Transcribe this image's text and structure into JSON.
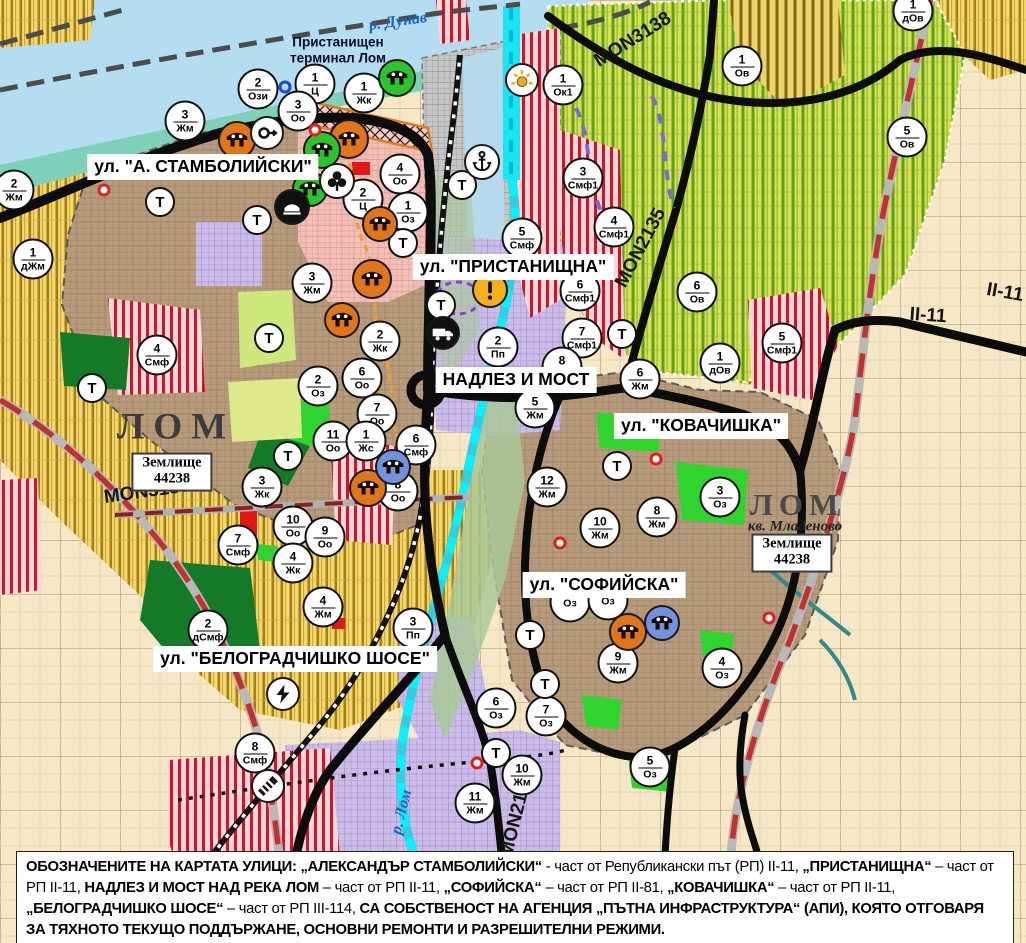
{
  "map": {
    "t_letter": "Т",
    "colors": {
      "water": "#b5ddf2",
      "river_cyan": "#18e4f4",
      "shore": "#7fd0b8",
      "urban": "#b79b7c",
      "center_pink": "#f2beb6",
      "industrial_lavender": "#cbbce8",
      "farmland_yellow": "#f4d76d",
      "orchard_green": "#dede52",
      "mixed_red_stripe": "#d01428",
      "park_green": "#2fd42f",
      "forest_green": "#157a28",
      "port_gray": "#c6c6c6",
      "road_black": "#0c0c0c",
      "project_road_red": "#c23030",
      "beige": "#f6e8c6",
      "marker_orange": "#e0761c",
      "marker_green": "#2cc42c",
      "marker_blue": "#7292de",
      "warning_orange": "#f3b01c"
    },
    "street_labels": [
      {
        "text": "ул. \"А. СТАМБОЛИЙСКИ\"",
        "x": 203,
        "y": 167
      },
      {
        "text": "ул. \"ПРИСТАНИЩНА\"",
        "x": 513,
        "y": 267
      },
      {
        "text": "НАДЛЕЗ И МОСТ",
        "x": 516,
        "y": 380
      },
      {
        "text": "ул. \"КОВАЧИШКА\"",
        "x": 701,
        "y": 426
      },
      {
        "text": "ул. \"СОФИЙСКА\"",
        "x": 604,
        "y": 585
      },
      {
        "text": "ул. \"БЕЛОГРАДЧИШКО ШОСЕ\"",
        "x": 295,
        "y": 659
      }
    ],
    "road_labels": [
      {
        "text": "MON3138",
        "x": 633,
        "y": 40,
        "rot": -32
      },
      {
        "text": "MON2135",
        "x": 641,
        "y": 248,
        "rot": -62
      },
      {
        "text": "MON3139",
        "x": 147,
        "y": 492,
        "rot": -8
      },
      {
        "text": "MON2136",
        "x": 517,
        "y": 815,
        "rot": -76
      },
      {
        "text": "II-11",
        "x": 928,
        "y": 316,
        "rot": 4
      },
      {
        "text": "II-11",
        "x": 1005,
        "y": 293,
        "rot": 10
      }
    ],
    "place_labels": [
      {
        "kind": "water",
        "text": "р. Дунав",
        "x": 398,
        "y": 22,
        "rot": -8
      },
      {
        "kind": "water",
        "text": "р. Лом",
        "x": 402,
        "y": 812,
        "rot": -76
      },
      {
        "kind": "port",
        "text": "Пристанищен\nтерминал Лом",
        "x": 338,
        "y": 50
      },
      {
        "kind": "city",
        "text": "ЛОМ",
        "x": 176,
        "y": 427,
        "small": false
      },
      {
        "kind": "city",
        "text": "ЛОМ",
        "x": 797,
        "y": 505,
        "small": true
      },
      {
        "kind": "quarter",
        "text": "кв. Младеново",
        "x": 795,
        "y": 527
      },
      {
        "kind": "box",
        "text": "Землище\n44238",
        "x": 172,
        "y": 472
      },
      {
        "kind": "box",
        "text": "Землище\n44238",
        "x": 792,
        "y": 553
      }
    ],
    "zone_markers": [
      {
        "n": "2",
        "c": "Ози",
        "x": 258,
        "y": 89
      },
      {
        "n": "1",
        "c": "Ц",
        "x": 315,
        "y": 84
      },
      {
        "n": "3",
        "c": "Оо",
        "x": 298,
        "y": 111
      },
      {
        "n": "1",
        "c": "Жк",
        "x": 364,
        "y": 93
      },
      {
        "n": "3",
        "c": "Жм",
        "x": 185,
        "y": 121
      },
      {
        "n": "2",
        "c": "Жм",
        "x": 14,
        "y": 190
      },
      {
        "n": "1",
        "c": "дЖм",
        "x": 33,
        "y": 259
      },
      {
        "n": "4",
        "c": "Оо",
        "x": 400,
        "y": 174
      },
      {
        "n": "2",
        "c": "Ц",
        "x": 363,
        "y": 199
      },
      {
        "n": "1",
        "c": "Оз",
        "x": 408,
        "y": 212
      },
      {
        "n": "3",
        "c": "Жм",
        "x": 312,
        "y": 283
      },
      {
        "n": "2",
        "c": "Жк",
        "x": 380,
        "y": 341
      },
      {
        "n": "6",
        "c": "Оо",
        "x": 362,
        "y": 378
      },
      {
        "n": "2",
        "c": "Оз",
        "x": 318,
        "y": 386
      },
      {
        "n": "7",
        "c": "Оо",
        "x": 377,
        "y": 414
      },
      {
        "n": "11",
        "c": "Оо",
        "x": 333,
        "y": 441
      },
      {
        "n": "1",
        "c": "Жс",
        "x": 366,
        "y": 441
      },
      {
        "n": "6",
        "c": "Смф",
        "x": 416,
        "y": 445
      },
      {
        "n": "8",
        "c": "Оо",
        "x": 398,
        "y": 491
      },
      {
        "n": "3",
        "c": "Жк",
        "x": 262,
        "y": 487
      },
      {
        "n": "4",
        "c": "Смф",
        "x": 157,
        "y": 355
      },
      {
        "n": "10",
        "c": "Оо",
        "x": 293,
        "y": 526
      },
      {
        "n": "9",
        "c": "Оо",
        "x": 325,
        "y": 537
      },
      {
        "n": "4",
        "c": "Жк",
        "x": 293,
        "y": 563
      },
      {
        "n": "4",
        "c": "Жм",
        "x": 323,
        "y": 607
      },
      {
        "n": "7",
        "c": "Смф",
        "x": 238,
        "y": 545
      },
      {
        "n": "2",
        "c": "дСмф",
        "x": 208,
        "y": 630
      },
      {
        "n": "3",
        "c": "Пп",
        "x": 413,
        "y": 628
      },
      {
        "n": "8",
        "c": "Смф",
        "x": 255,
        "y": 753
      },
      {
        "n": "5",
        "c": "Смф",
        "x": 522,
        "y": 238
      },
      {
        "n": "6",
        "c": "Смф1",
        "x": 580,
        "y": 291
      },
      {
        "n": "7",
        "c": "Смф1",
        "x": 582,
        "y": 338
      },
      {
        "n": "8",
        "c": "Жм",
        "x": 562,
        "y": 367
      },
      {
        "n": "6",
        "c": "Жм",
        "x": 640,
        "y": 379
      },
      {
        "n": "5",
        "c": "Жм",
        "x": 535,
        "y": 408
      },
      {
        "n": "2",
        "c": "Пп",
        "x": 498,
        "y": 347
      },
      {
        "n": "12",
        "c": "Жм",
        "x": 547,
        "y": 487
      },
      {
        "n": "3",
        "c": "Оз",
        "x": 720,
        "y": 497
      },
      {
        "n": "8",
        "c": "Жм",
        "x": 657,
        "y": 517
      },
      {
        "n": "10",
        "c": "Жм",
        "x": 600,
        "y": 528
      },
      {
        "n": "",
        "c": "Оз",
        "x": 570,
        "y": 602
      },
      {
        "n": "",
        "c": "Оз",
        "x": 608,
        "y": 600
      },
      {
        "n": "9",
        "c": "Жм",
        "x": 618,
        "y": 663
      },
      {
        "n": "4",
        "c": "Оз",
        "x": 722,
        "y": 668
      },
      {
        "n": "5",
        "c": "Оз",
        "x": 650,
        "y": 767
      },
      {
        "n": "6",
        "c": "Оз",
        "x": 496,
        "y": 708
      },
      {
        "n": "7",
        "c": "Оз",
        "x": 546,
        "y": 716
      },
      {
        "n": "10",
        "c": "Жм",
        "x": 522,
        "y": 775
      },
      {
        "n": "11",
        "c": "Жм",
        "x": 475,
        "y": 803
      },
      {
        "n": "1",
        "c": "Ок1",
        "x": 563,
        "y": 85
      },
      {
        "n": "3",
        "c": "Смф1",
        "x": 583,
        "y": 178
      },
      {
        "n": "4",
        "c": "Смф1",
        "x": 614,
        "y": 227
      },
      {
        "n": "1",
        "c": "Ов",
        "x": 742,
        "y": 66
      },
      {
        "n": "5",
        "c": "Ов",
        "x": 907,
        "y": 137
      },
      {
        "n": "6",
        "c": "Ов",
        "x": 697,
        "y": 292
      },
      {
        "n": "1",
        "c": "дОв",
        "x": 720,
        "y": 363
      },
      {
        "n": "5",
        "c": "Смф1",
        "x": 782,
        "y": 343
      },
      {
        "n": "1",
        "c": "дОв",
        "x": 913,
        "y": 11
      }
    ],
    "t_markers": [
      {
        "x": 160,
        "y": 202
      },
      {
        "x": 257,
        "y": 220
      },
      {
        "x": 462,
        "y": 185
      },
      {
        "x": 403,
        "y": 243
      },
      {
        "x": 269,
        "y": 338
      },
      {
        "x": 288,
        "y": 456
      },
      {
        "x": 92,
        "y": 388
      },
      {
        "x": 617,
        "y": 466
      },
      {
        "x": 530,
        "y": 635
      },
      {
        "x": 545,
        "y": 684
      },
      {
        "x": 496,
        "y": 753
      },
      {
        "x": 441,
        "y": 305
      },
      {
        "x": 622,
        "y": 334
      }
    ],
    "icon_markers": [
      {
        "name": "cultural-monument",
        "icon": "ruin",
        "bg": "#e0761c",
        "x": 237,
        "y": 140,
        "size": 38
      },
      {
        "name": "cultural-monument",
        "icon": "ruin",
        "bg": "#e0761c",
        "x": 349,
        "y": 139,
        "size": 40
      },
      {
        "name": "cultural-monument",
        "icon": "ruin",
        "bg": "#e0761c",
        "x": 380,
        "y": 224,
        "size": 36
      },
      {
        "name": "cultural-monument",
        "icon": "ruin",
        "bg": "#e0761c",
        "x": 372,
        "y": 279,
        "size": 40
      },
      {
        "name": "cultural-monument",
        "icon": "ruin",
        "bg": "#e0761c",
        "x": 342,
        "y": 320,
        "size": 36
      },
      {
        "name": "cultural-monument",
        "icon": "ruin",
        "bg": "#e0761c",
        "x": 368,
        "y": 488,
        "size": 38
      },
      {
        "name": "cultural-monument",
        "icon": "ruin",
        "bg": "#e0761c",
        "x": 628,
        "y": 632,
        "size": 38
      },
      {
        "name": "cultural-monument-green",
        "icon": "ruin",
        "bg": "#2cc42c",
        "x": 397,
        "y": 78,
        "size": 38
      },
      {
        "name": "cultural-monument-green",
        "icon": "ruin",
        "bg": "#2cc42c",
        "x": 322,
        "y": 150,
        "size": 38
      },
      {
        "name": "cultural-monument-green",
        "icon": "ruin",
        "bg": "#2cc42c",
        "x": 310,
        "y": 189,
        "size": 36
      },
      {
        "name": "cultural-monument-blue",
        "icon": "ruin",
        "bg": "#7292de",
        "x": 393,
        "y": 467,
        "size": 36
      },
      {
        "name": "cultural-monument-blue",
        "icon": "ruin",
        "bg": "#7292de",
        "x": 662,
        "y": 623,
        "size": 36
      },
      {
        "name": "religious-site",
        "icon": "trefoil",
        "bg": "#ffffff",
        "x": 337,
        "y": 181,
        "size": 36
      },
      {
        "name": "tunnel-arch",
        "icon": "arch",
        "bg": "#111111",
        "x": 292,
        "y": 207,
        "size": 36
      },
      {
        "name": "key-arrow",
        "icon": "key",
        "bg": "#ffffff",
        "x": 267,
        "y": 133,
        "size": 34
      },
      {
        "name": "port-anchor",
        "icon": "anchor",
        "bg": "#ffffff",
        "x": 482,
        "y": 162,
        "size": 36
      },
      {
        "name": "sun-rays",
        "icon": "sun",
        "bg": "#ffffff",
        "x": 522,
        "y": 80,
        "size": 34
      },
      {
        "name": "warning",
        "icon": "warning",
        "bg": "#f3b01c",
        "x": 490,
        "y": 290,
        "size": 36
      },
      {
        "name": "truck-terminal",
        "icon": "truck",
        "bg": "#111111",
        "x": 443,
        "y": 333,
        "size": 34
      },
      {
        "name": "power-bolt",
        "icon": "bolt",
        "bg": "#ffffff",
        "x": 283,
        "y": 694,
        "size": 34
      },
      {
        "name": "rail-crossing",
        "icon": "railcross",
        "bg": "#ffffff",
        "x": 268,
        "y": 786,
        "size": 34
      },
      {
        "name": "buoy-ring",
        "icon": "buoy",
        "bg": "none",
        "x": 285,
        "y": 87,
        "size": 13
      }
    ],
    "red_dots": [
      {
        "x": 104,
        "y": 190
      },
      {
        "x": 125,
        "y": 168
      },
      {
        "x": 315,
        "y": 130
      },
      {
        "x": 656,
        "y": 459
      },
      {
        "x": 560,
        "y": 543
      },
      {
        "x": 477,
        "y": 763
      },
      {
        "x": 769,
        "y": 618
      }
    ],
    "caption": {
      "segments": [
        {
          "t": "ОБОЗНАЧЕНИТЕ НА КАРТАТА УЛИЦИ: „АЛЕКСАНДЪР СТАМБОЛИЙСКИ“",
          "b": true
        },
        {
          "t": " - част от Републикански път (РП) II-11, ",
          "b": false
        },
        {
          "t": "„ПРИСТАНИЩНА“",
          "b": true
        },
        {
          "t": " – част от РП II-11, ",
          "b": false
        },
        {
          "t": "НАДЛЕЗ И МОСТ НАД РЕКА ЛОМ",
          "b": true
        },
        {
          "t": " – част от РП II-11, ",
          "b": false
        },
        {
          "t": "„СОФИЙСКА“",
          "b": true
        },
        {
          "t": " – част от РП II-81, ",
          "b": false
        },
        {
          "t": "„КОВАЧИШКА“",
          "b": true
        },
        {
          "t": " – част от РП II-11, ",
          "b": false
        },
        {
          "t": "„БЕЛОГРАДЧИШКО ШОСЕ“",
          "b": true
        },
        {
          "t": " – част от РП III-114, ",
          "b": false
        },
        {
          "t": "СА СОБСТВЕНОСТ НА АГЕНЦИЯ „ПЪТНА ИНФРАСТРУКТУРА“ (АПИ), КОЯТО ОТГОВАРЯ ЗА ТЯХНОТО ТЕКУЩО ПОДДЪРЖАНЕ, ОСНОВНИ РЕМОНТИ И РАЗРЕШИТЕЛНИ РЕЖИМИ.",
          "b": true
        }
      ]
    }
  }
}
